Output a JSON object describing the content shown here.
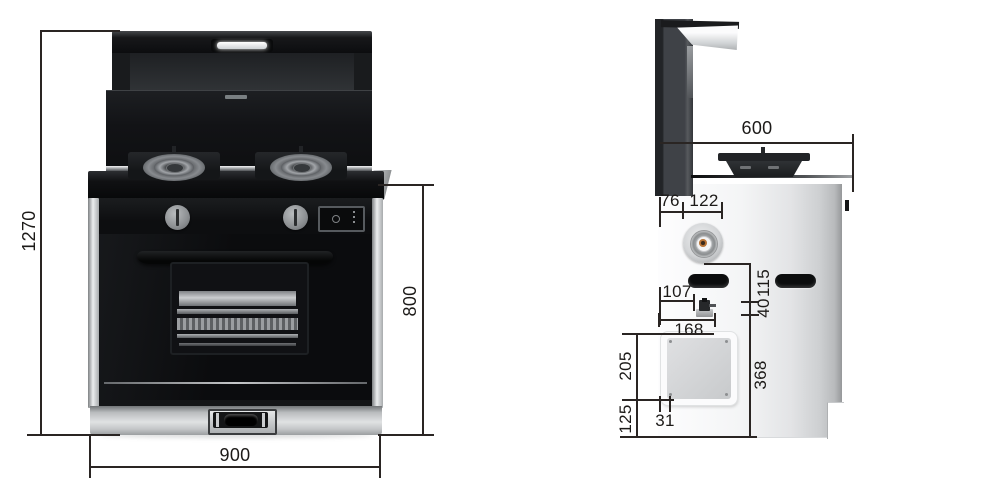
{
  "dimensions": {
    "total_height": "1270",
    "body_height": "800",
    "width": "900",
    "depth": "600",
    "hood_back_depth": "76",
    "gas_inlet_offset": "122",
    "valve_offset": "107",
    "panel_offset": "168",
    "slot_drop": "115",
    "valve_drop": "40",
    "lower_zone_height": "368",
    "panel_height": "205",
    "bottom_clearance": "125",
    "panel_side_inset": "31"
  }
}
